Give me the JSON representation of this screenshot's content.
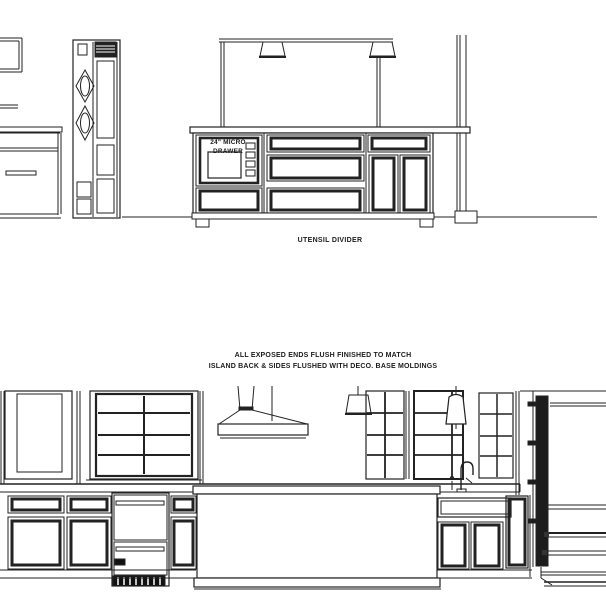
{
  "page": {
    "background_color": "#ffffff",
    "line_color": "#222222"
  },
  "top_drawing": {
    "title": "island-elevation",
    "micro_drawer_label": {
      "line1": "24\" MICRO",
      "line2": "DRAWER"
    },
    "caption": "UTENSIL DIVIDER"
  },
  "bottom_drawing": {
    "title": "kitchen-wall-elevation",
    "note": {
      "line1": "ALL EXPOSED ENDS FLUSH FINISHED TO MATCH",
      "line2": "ISLAND BACK & SIDES FLUSHED WITH DECO. BASE MOLDINGS"
    }
  }
}
